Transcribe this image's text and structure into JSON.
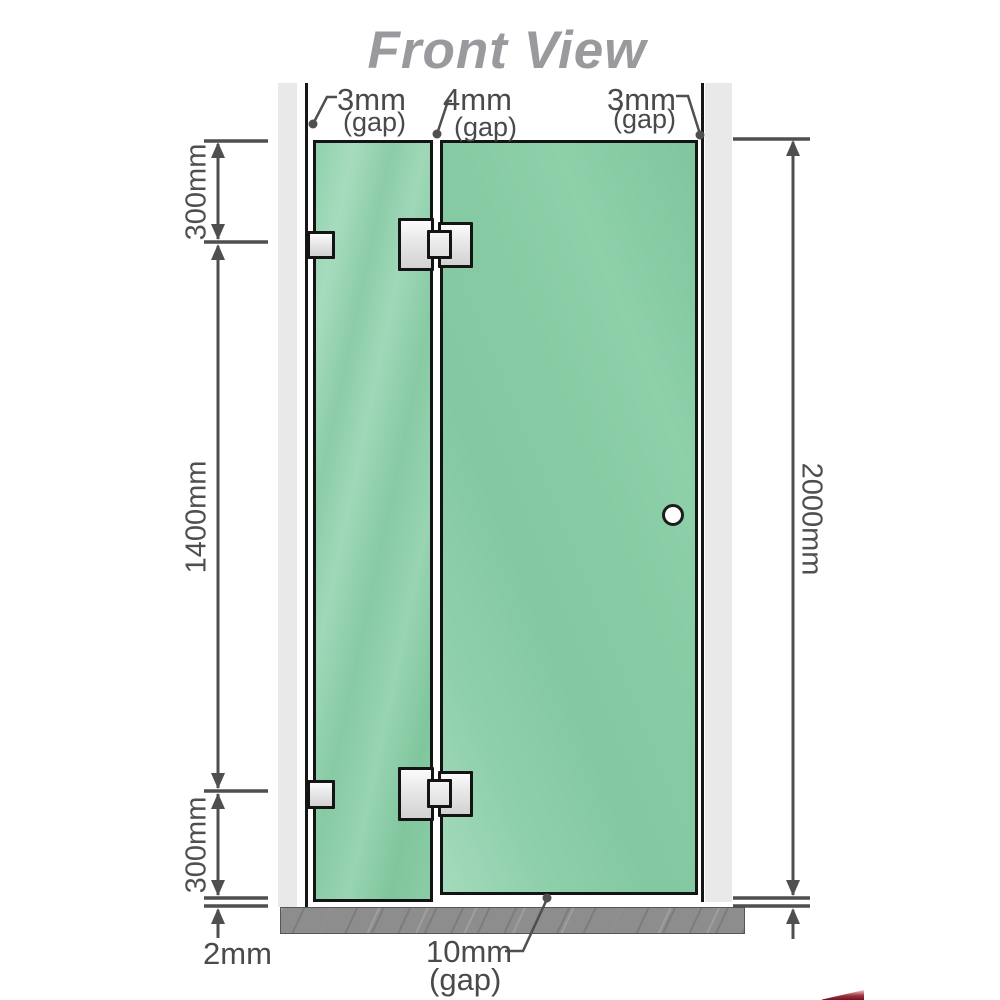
{
  "title": "Front View",
  "top_gap_labels": {
    "left": {
      "value": "3mm",
      "note": "(gap)"
    },
    "middle": {
      "value": "4mm",
      "note": "(gap)"
    },
    "right": {
      "value": "3mm",
      "note": "(gap)"
    }
  },
  "left_dimensions": {
    "top_segment": "300mm",
    "middle_segment": "1400mm",
    "bottom_segment": "300mm",
    "floor_clearance": "2mm"
  },
  "right_dimensions": {
    "overall_height": "2000mm"
  },
  "bottom_gap_label": {
    "value": "10mm",
    "note": "(gap)"
  },
  "colors": {
    "glass_green": "#8acca6",
    "glass_highlight": "#a6dcbd",
    "dimension_line": "#4f4f4f",
    "title_gray": "#9a9a9e",
    "wall_channel_gray": "#e9e9e9",
    "floor_gray": "#8d8d8d",
    "hardware_silver": "#e9e9e9",
    "outline_black": "#141414",
    "logo_red": "#6e121e"
  }
}
